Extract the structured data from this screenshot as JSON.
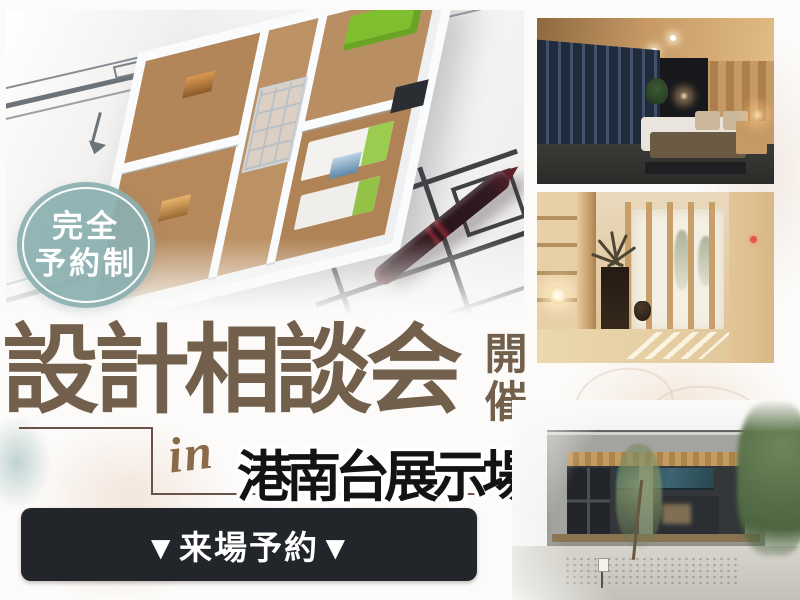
{
  "badge": {
    "line1": "完全",
    "line2": "予約制"
  },
  "event": {
    "title": "設計相談会",
    "status_vertical": "開催",
    "in_word": "in",
    "venue": "港南台展示場"
  },
  "cta": {
    "label": "▼来場予約▼"
  },
  "colors": {
    "badge_teal": "#8bafb0",
    "title_brown": "#72604c",
    "frame_line_brown": "#6b5248",
    "venue_black": "#131313",
    "cta_background": "#22262a",
    "cta_text": "#ffffff"
  }
}
